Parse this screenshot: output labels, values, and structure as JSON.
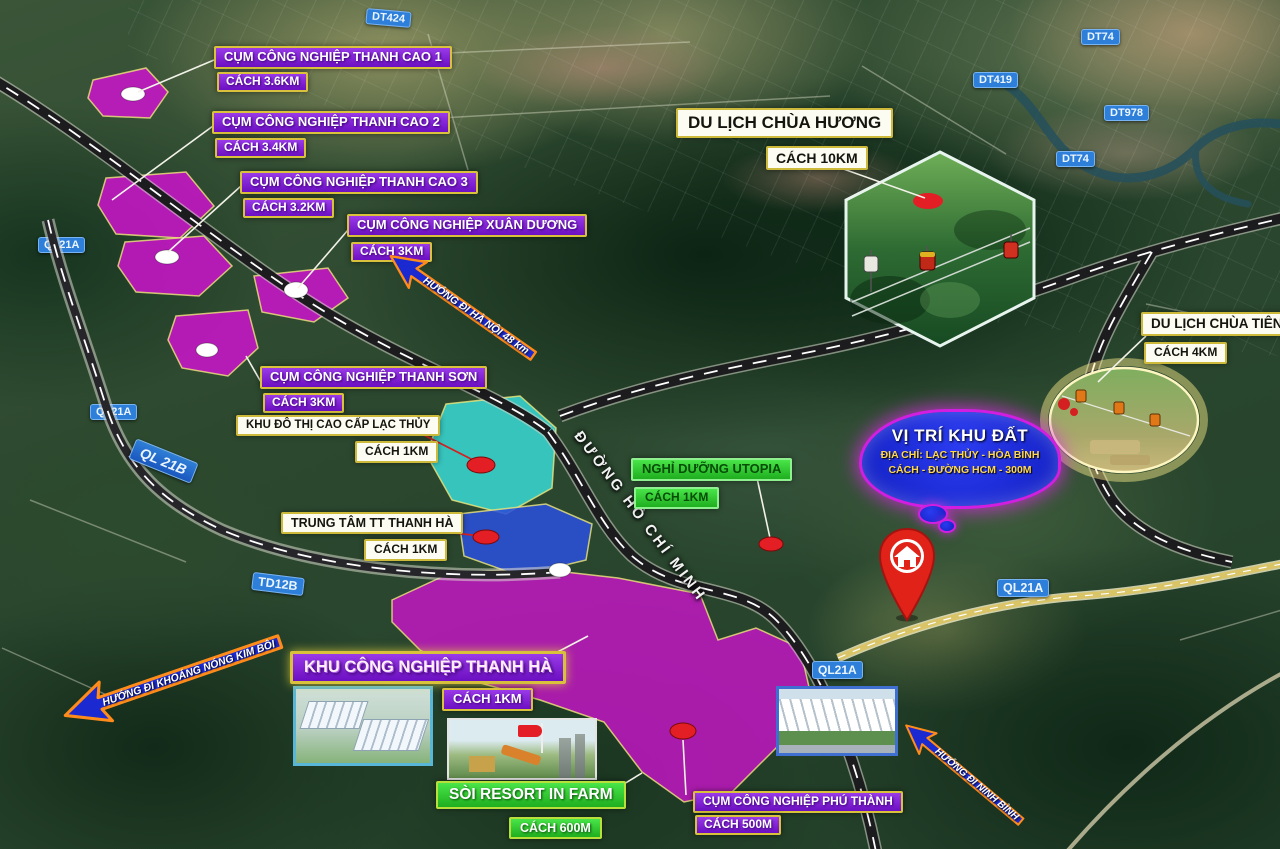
{
  "industrial": [
    {
      "name": "CỤM CÔNG NGHIỆP THANH CAO 1",
      "dist": "CÁCH 3.6KM"
    },
    {
      "name": "CỤM CÔNG NGHIỆP THANH CAO 2",
      "dist": "CÁCH 3.4KM"
    },
    {
      "name": "CỤM CÔNG NGHIỆP THANH CAO 3",
      "dist": "CÁCH 3.2KM"
    },
    {
      "name": "CỤM CÔNG NGHIỆP XUÂN DƯƠNG",
      "dist": "CÁCH 3KM"
    },
    {
      "name": "CỤM CÔNG NGHIỆP THANH SƠN",
      "dist": "CÁCH 3KM"
    },
    {
      "name": "KHU CÔNG NGHIỆP THANH HÀ",
      "dist": "CÁCH 1KM"
    },
    {
      "name": "CỤM CÔNG NGHIỆP PHÚ THÀNH",
      "dist": "CÁCH 500M"
    }
  ],
  "tourism": [
    {
      "name": "DU LỊCH CHÙA HƯƠNG",
      "dist": "CÁCH 10KM"
    },
    {
      "name": "DU LỊCH CHÙA TIÊN",
      "dist": "CÁCH 4KM"
    }
  ],
  "places": [
    {
      "name": "KHU ĐÔ THỊ CAO CẤP LẠC THỦY",
      "dist": "CÁCH 1KM"
    },
    {
      "name": "TRUNG TÂM TT THANH HÀ",
      "dist": "CÁCH 1KM"
    }
  ],
  "resorts": [
    {
      "name": "NGHỈ DƯỠNG UTOPIA",
      "dist": "CÁCH 1KM"
    },
    {
      "name": "SÒI RESORT IN FARM",
      "dist": "CÁCH 600M"
    }
  ],
  "property": {
    "title": "VỊ TRÍ KHU ĐẤT",
    "address": "ĐỊA CHỈ: LẠC THỦY - HÒA BÌNH",
    "distance": "CÁCH - ĐƯỜNG HCM - 300M"
  },
  "roads": {
    "dt424": "DT424",
    "dt74_top": "DT74",
    "dt419": "DT419",
    "dt978": "DT978",
    "dt74_mid": "DT74",
    "ql21a_topleft": "QL21A",
    "ql21a_left": "QL21A",
    "ql21b": "QL 21B",
    "td12b": "TD12B",
    "ql21a_mid": "QL21A",
    "ql21a_right": "QL21A",
    "hcm": "ĐƯỜNG HỒ CHÍ MINH"
  },
  "arrows": {
    "hanoi": "HƯỚNG ĐI HÀ NỘI 48 km",
    "kimboi": "HƯỚNG ĐI KHOÁNG NÓNG KIM BÔI",
    "ninhbinh": "HƯỚNG ĐI NINH BÌNH"
  },
  "colors": {
    "magenta_zone": "#cc14cc",
    "cyan_zone": "#38d2cc",
    "blue_zone": "#2a50d8",
    "badge_purple": "#7d1fd4",
    "badge_border_yellow": "#d9c13c",
    "badge_green": "#2ec52e",
    "road_label_blue": "#2e7fd9",
    "arrow_blue": "#1b2ad0",
    "arrow_border_orange": "#ff8c1a",
    "marker_red": "#e02219"
  }
}
